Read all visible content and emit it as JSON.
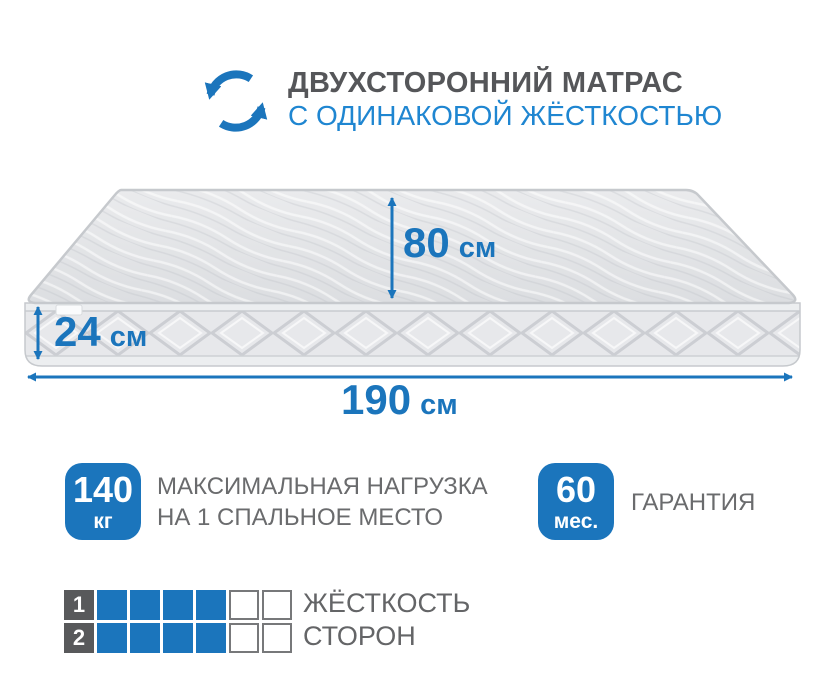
{
  "header": {
    "icon": "rotate-arrows-icon",
    "title": "ДВУХСТОРОННИЙ МАТРАС",
    "subtitle": "С ОДИНАКОВОЙ ЖЁСТКОСТЬЮ"
  },
  "dimensions": {
    "width": {
      "value": "80",
      "unit": "см"
    },
    "height": {
      "value": "24",
      "unit": "см"
    },
    "length": {
      "value": "190",
      "unit": "см"
    }
  },
  "features": [
    {
      "badge_value": "140",
      "badge_unit": "кг",
      "label_line1": "МАКСИМАЛЬНАЯ НАГРУЗКА",
      "label_line2": "НА 1 СПАЛЬНОЕ МЕСТО"
    },
    {
      "badge_value": "60",
      "badge_unit": "мес.",
      "label_line1": "ГАРАНТИЯ",
      "label_line2": ""
    }
  ],
  "hardness": {
    "rows": [
      {
        "side": "1",
        "filled": 4,
        "total": 6
      },
      {
        "side": "2",
        "filled": 4,
        "total": 6
      }
    ],
    "caption_line1": "ЖЁСТКОСТЬ",
    "caption_line2": "СТОРОН"
  },
  "colors": {
    "blue": "#1b75bc",
    "light_blue": "#1f86d1",
    "dark_gray": "#555659",
    "mid_gray": "#6a6b6d"
  }
}
